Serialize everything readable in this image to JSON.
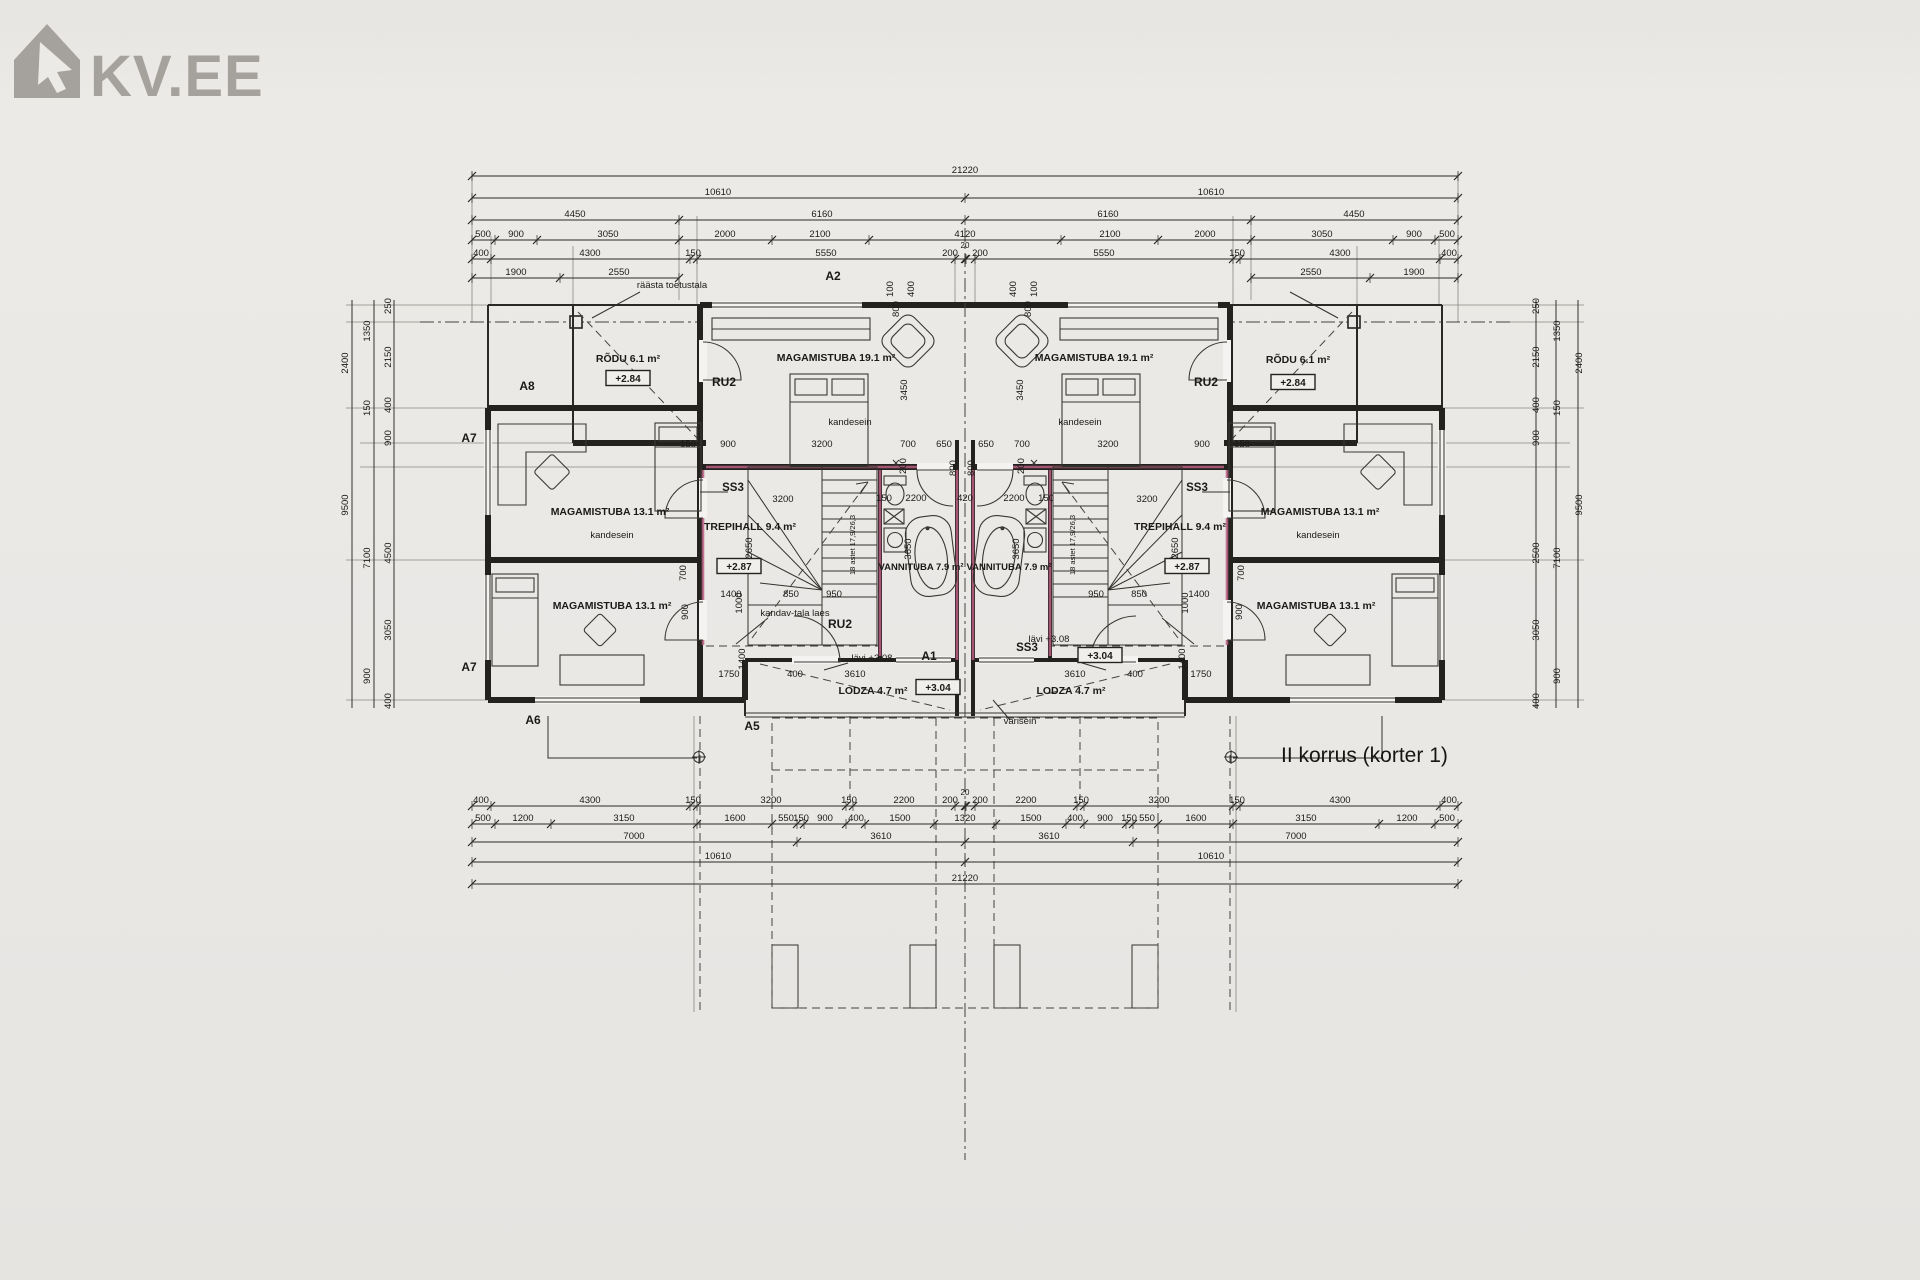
{
  "logo": {
    "text": "KV.EE",
    "icon": "house-cursor-icon",
    "color": "#a5a19c"
  },
  "caption": "II korrus (korter 1)",
  "colors": {
    "paper": "#eae8e5",
    "ink": "#1b1a18",
    "wall": "#24221e",
    "wall_accent": "#b85f84",
    "logo": "#a5a19c"
  },
  "dim_rows": [
    {
      "y": 176,
      "ticks": [
        472,
        1458
      ],
      "labels": [
        [
          "21220",
          965
        ]
      ]
    },
    {
      "y": 198,
      "ticks": [
        472,
        965,
        1458
      ],
      "labels": [
        [
          "10610",
          718
        ],
        [
          "10610",
          1211
        ]
      ]
    },
    {
      "y": 220,
      "ticks": [
        472,
        679,
        965,
        1251,
        1458
      ],
      "labels": [
        [
          "4450",
          575
        ],
        [
          "6160",
          822
        ],
        [
          "6160",
          1108
        ],
        [
          "4450",
          1354
        ]
      ]
    },
    {
      "y": 240,
      "ticks": [
        472,
        495,
        537,
        679,
        772,
        869,
        1061,
        1158,
        1251,
        1393,
        1435,
        1458
      ],
      "labels": [
        [
          "500",
          483
        ],
        [
          "900",
          516
        ],
        [
          "3050",
          608
        ],
        [
          "2000",
          725
        ],
        [
          "2100",
          820
        ],
        [
          "4120",
          965
        ],
        [
          "2100",
          1110
        ],
        [
          "2000",
          1205
        ],
        [
          "3050",
          1322
        ],
        [
          "900",
          1414
        ],
        [
          "500",
          1447
        ]
      ]
    },
    {
      "y": 259,
      "ticks": [
        472,
        491,
        690,
        697,
        955,
        965,
        966,
        975,
        1233,
        1240,
        1440,
        1458
      ],
      "labels": [
        [
          "400",
          481
        ],
        [
          "4300",
          590
        ],
        [
          "150",
          693
        ],
        [
          "5550",
          826
        ],
        [
          "200",
          950
        ],
        [
          "20",
          965,
          -8
        ],
        [
          "200",
          980
        ],
        [
          "5550",
          1104
        ],
        [
          "150",
          1237
        ],
        [
          "4300",
          1340
        ],
        [
          "400",
          1449
        ]
      ]
    },
    {
      "y": 278,
      "spans": [
        [
          472,
          679
        ],
        [
          1251,
          1458
        ]
      ],
      "ticks": [
        472,
        560,
        679,
        1251,
        1370,
        1458
      ],
      "labels": [
        [
          "1900",
          516
        ],
        [
          "2550",
          619
        ],
        [
          "2550",
          1311
        ],
        [
          "1900",
          1414
        ]
      ]
    },
    {
      "y": 806,
      "ticks": [
        472,
        491,
        690,
        697,
        846,
        853,
        955,
        965,
        966,
        975,
        1077,
        1084,
        1233,
        1240,
        1440,
        1458
      ],
      "labels": [
        [
          "400",
          481
        ],
        [
          "4300",
          590
        ],
        [
          "150",
          693
        ],
        [
          "3200",
          771
        ],
        [
          "150",
          849
        ],
        [
          "2200",
          904
        ],
        [
          "200",
          950
        ],
        [
          "20",
          965,
          -8
        ],
        [
          "200",
          980
        ],
        [
          "2200",
          1026
        ],
        [
          "150",
          1081
        ],
        [
          "3200",
          1159
        ],
        [
          "150",
          1237
        ],
        [
          "4300",
          1340
        ],
        [
          "400",
          1449
        ]
      ]
    },
    {
      "y": 824,
      "ticks": [
        472,
        495,
        551,
        697,
        772,
        797,
        804,
        846,
        865,
        934,
        996,
        1066,
        1084,
        1126,
        1133,
        1158,
        1233,
        1379,
        1435,
        1458
      ],
      "labels": [
        [
          "500",
          483
        ],
        [
          "1200",
          523
        ],
        [
          "3150",
          624
        ],
        [
          "1600",
          735
        ],
        [
          "550",
          786
        ],
        [
          "150",
          801
        ],
        [
          "900",
          825
        ],
        [
          "400",
          856
        ],
        [
          "1500",
          900
        ],
        [
          "1320",
          965
        ],
        [
          "1500",
          1031
        ],
        [
          "400",
          1075
        ],
        [
          "900",
          1105
        ],
        [
          "150",
          1129
        ],
        [
          "550",
          1147
        ],
        [
          "1600",
          1196
        ],
        [
          "3150",
          1306
        ],
        [
          "1200",
          1407
        ],
        [
          "500",
          1447
        ]
      ]
    },
    {
      "y": 842,
      "ticks": [
        472,
        797,
        965,
        1133,
        1458
      ],
      "labels": [
        [
          "7000",
          634
        ],
        [
          "3610",
          881
        ],
        [
          "3610",
          1049
        ],
        [
          "7000",
          1296
        ]
      ]
    },
    {
      "y": 862,
      "ticks": [
        472,
        965,
        1458
      ],
      "labels": [
        [
          "10610",
          718
        ],
        [
          "10610",
          1211
        ]
      ]
    },
    {
      "y": 884,
      "ticks": [
        472,
        1458
      ],
      "labels": [
        [
          "21220",
          965
        ]
      ]
    }
  ],
  "h_dims": [
    [
      "150",
      688,
      447
    ],
    [
      "900",
      728,
      447
    ],
    [
      "3200",
      822,
      447
    ],
    [
      "700",
      908,
      447
    ],
    [
      "650",
      944,
      447
    ],
    [
      "650",
      986,
      447
    ],
    [
      "700",
      1022,
      447
    ],
    [
      "3200",
      1108,
      447
    ],
    [
      "900",
      1202,
      447
    ],
    [
      "150",
      1242,
      447
    ],
    [
      "3200",
      783,
      502
    ],
    [
      "3200",
      1147,
      502
    ],
    [
      "150",
      884,
      501
    ],
    [
      "2200",
      916,
      501
    ],
    [
      "420",
      965,
      501
    ],
    [
      "2200",
      1014,
      501
    ],
    [
      "150",
      1046,
      501
    ],
    [
      "1400",
      731,
      597
    ],
    [
      "850",
      791,
      597
    ],
    [
      "950",
      834,
      597
    ],
    [
      "950",
      1096,
      597
    ],
    [
      "850",
      1139,
      597
    ],
    [
      "1400",
      1199,
      597
    ],
    [
      "1750",
      729,
      677
    ],
    [
      "400",
      795,
      677
    ],
    [
      "3610",
      855,
      677
    ],
    [
      "3610",
      1075,
      677
    ],
    [
      "400",
      1135,
      677
    ],
    [
      "1750",
      1201,
      677
    ]
  ],
  "v_dims": [
    [
      "3450",
      907,
      390
    ],
    [
      "3450",
      1023,
      390
    ],
    [
      "2650",
      752,
      548
    ],
    [
      "2650",
      1178,
      548
    ],
    [
      "3650",
      911,
      549
    ],
    [
      "3650",
      1019,
      549
    ],
    [
      "1000",
      742,
      603
    ],
    [
      "1000",
      1188,
      603
    ],
    [
      "1400",
      745,
      659
    ],
    [
      "1400",
      1185,
      659
    ],
    [
      "900",
      688,
      612
    ],
    [
      "900",
      1242,
      612
    ],
    [
      "700",
      686,
      573
    ],
    [
      "700",
      1244,
      573
    ],
    [
      "200",
      906,
      466
    ],
    [
      "200",
      1024,
      466
    ],
    [
      "800",
      956,
      468
    ],
    [
      "800",
      974,
      468
    ],
    [
      "100",
      893,
      289
    ],
    [
      "100",
      1037,
      289
    ],
    [
      "400",
      914,
      289
    ],
    [
      "400",
      1016,
      289
    ],
    [
      "800",
      899,
      309
    ],
    [
      "800",
      1031,
      309
    ],
    [
      "250",
      391,
      306
    ],
    [
      "1350",
      370,
      331
    ],
    [
      "2150",
      391,
      357
    ],
    [
      "2400",
      348,
      363
    ],
    [
      "400",
      391,
      405
    ],
    [
      "150",
      370,
      408
    ],
    [
      "900",
      391,
      438
    ],
    [
      "9500",
      348,
      505
    ],
    [
      "4500",
      391,
      553
    ],
    [
      "7100",
      370,
      558
    ],
    [
      "3050",
      391,
      630
    ],
    [
      "900",
      370,
      676
    ],
    [
      "400",
      391,
      701
    ],
    [
      "250",
      1539,
      306
    ],
    [
      "1350",
      1560,
      331
    ],
    [
      "2150",
      1539,
      357
    ],
    [
      "2400",
      1582,
      363
    ],
    [
      "400",
      1539,
      405
    ],
    [
      "150",
      1560,
      408
    ],
    [
      "900",
      1539,
      438
    ],
    [
      "9500",
      1582,
      505
    ],
    [
      "2500",
      1539,
      553
    ],
    [
      "7100",
      1560,
      558
    ],
    [
      "3050",
      1539,
      630
    ],
    [
      "900",
      1560,
      676
    ],
    [
      "400",
      1539,
      701
    ],
    [
      "18 astet 17,9/26,3",
      855,
      545,
      7.5
    ],
    [
      "18 astet 17,9/26,3",
      1075,
      545,
      7.5
    ]
  ],
  "plan_labels": [
    {
      "n": "axis-label-a2",
      "t": "A2",
      "x": 833,
      "y": 280,
      "s": 12,
      "b": 1
    },
    {
      "n": "note-raasta-toetustala",
      "t": "räästa toetustala",
      "x": 672,
      "y": 288,
      "s": 9.5
    },
    {
      "n": "room-rodu-left",
      "t": "RÕDU 6.1 m²",
      "x": 628,
      "y": 362,
      "s": 10.5,
      "b": 1
    },
    {
      "n": "axis-label-a8",
      "t": "A8",
      "x": 527,
      "y": 390,
      "s": 12,
      "b": 1
    },
    {
      "n": "door-code-ru2-left-top",
      "t": "RU2",
      "x": 724,
      "y": 386,
      "s": 12,
      "b": 1
    },
    {
      "n": "room-magamistuba-19-left",
      "t": "MAGAMISTUBA 19.1 m²",
      "x": 836,
      "y": 361,
      "s": 10.5,
      "b": 1
    },
    {
      "n": "note-kandesein-left-top",
      "t": "kandesein",
      "x": 850,
      "y": 425,
      "s": 9.5
    },
    {
      "n": "axis-label-a7-upper",
      "t": "A7",
      "x": 469,
      "y": 442,
      "s": 12,
      "b": 1
    },
    {
      "n": "room-magamistuba-13-left-upper",
      "t": "MAGAMISTUBA 13.1 m²",
      "x": 610,
      "y": 515,
      "s": 10.5,
      "b": 1
    },
    {
      "n": "note-kandesein-left-mid",
      "t": "kandesein",
      "x": 612,
      "y": 538,
      "s": 9.5
    },
    {
      "n": "window-code-ss3-left",
      "t": "SS3",
      "x": 733,
      "y": 491,
      "s": 11.5,
      "b": 1
    },
    {
      "n": "room-trepihall-left",
      "t": "TREPIHALL 9.4 m²",
      "x": 750,
      "y": 530,
      "s": 10.5,
      "b": 1
    },
    {
      "n": "room-vannituba-left",
      "t": "VANNITUBA 7.9 m²",
      "x": 921,
      "y": 570,
      "s": 9.5,
      "b": 1
    },
    {
      "n": "room-magamistuba-13-left-lower",
      "t": "MAGAMISTUBA 13.1 m²",
      "x": 612,
      "y": 609,
      "s": 10.5,
      "b": 1
    },
    {
      "n": "axis-label-a7-lower",
      "t": "A7",
      "x": 469,
      "y": 671,
      "s": 12,
      "b": 1
    },
    {
      "n": "note-kandav-tala",
      "t": "kandav-tala laes",
      "x": 795,
      "y": 616,
      "s": 9.5
    },
    {
      "n": "door-code-ru2-left-bottom",
      "t": "RU2",
      "x": 840,
      "y": 628,
      "s": 12,
      "b": 1
    },
    {
      "n": "note-lavi-left",
      "t": "lävi +3.08",
      "x": 872,
      "y": 661,
      "s": 9.5
    },
    {
      "n": "axis-label-a1",
      "t": "A1",
      "x": 929,
      "y": 660,
      "s": 12,
      "b": 1
    },
    {
      "n": "room-lodza-left",
      "t": "LODZA 4.7 m²",
      "x": 873,
      "y": 694,
      "s": 10.5,
      "b": 1
    },
    {
      "n": "axis-label-a6",
      "t": "A6",
      "x": 533,
      "y": 724,
      "s": 12,
      "b": 1
    },
    {
      "n": "axis-label-a5",
      "t": "A5",
      "x": 752,
      "y": 730,
      "s": 12,
      "b": 1
    },
    {
      "n": "note-varisein",
      "t": "varisein",
      "x": 1020,
      "y": 724,
      "s": 9.5
    },
    {
      "n": "room-magamistuba-19-right",
      "t": "MAGAMISTUBA 19.1 m²",
      "x": 1094,
      "y": 361,
      "s": 10.5,
      "b": 1
    },
    {
      "n": "note-kandesein-right-top",
      "t": "kandesein",
      "x": 1080,
      "y": 425,
      "s": 9.5
    },
    {
      "n": "room-rodu-right",
      "t": "RÕDU 6.1 m²",
      "x": 1298,
      "y": 363,
      "s": 10.5,
      "b": 1
    },
    {
      "n": "door-code-ru2-right-top",
      "t": "RU2",
      "x": 1206,
      "y": 386,
      "s": 12,
      "b": 1
    },
    {
      "n": "window-code-ss3-right",
      "t": "SS3",
      "x": 1197,
      "y": 491,
      "s": 11.5,
      "b": 1
    },
    {
      "n": "room-trepihall-right",
      "t": "TREPIHALL 9.4 m²",
      "x": 1180,
      "y": 530,
      "s": 10.5,
      "b": 1
    },
    {
      "n": "room-vannituba-right",
      "t": "VANNITUBA 7.9 m²",
      "x": 1009,
      "y": 570,
      "s": 9.5,
      "b": 1
    },
    {
      "n": "room-magamistuba-13-right-upper",
      "t": "MAGAMISTUBA 13.1 m²",
      "x": 1320,
      "y": 515,
      "s": 10.5,
      "b": 1
    },
    {
      "n": "note-kandesein-right-mid",
      "t": "kandesein",
      "x": 1318,
      "y": 538,
      "s": 9.5
    },
    {
      "n": "room-magamistuba-13-right-lower",
      "t": "MAGAMISTUBA 13.1 m²",
      "x": 1316,
      "y": 609,
      "s": 10.5,
      "b": 1
    },
    {
      "n": "window-code-ss3-right-bottom",
      "t": "SS3",
      "x": 1027,
      "y": 651,
      "s": 11.5,
      "b": 1
    },
    {
      "n": "note-lavi-right",
      "t": "lävi +3.08",
      "x": 1049,
      "y": 642,
      "s": 9.5
    },
    {
      "n": "room-lodza-right",
      "t": "LODZA 4.7 m²",
      "x": 1071,
      "y": 694,
      "s": 10.5,
      "b": 1
    }
  ],
  "boxed_labels": [
    {
      "n": "elevation-rodu-left",
      "t": "+2.84",
      "x": 628,
      "y": 382
    },
    {
      "n": "elevation-rodu-right",
      "t": "+2.84",
      "x": 1293,
      "y": 386
    },
    {
      "n": "elevation-trepihall-left",
      "t": "+2.87",
      "x": 739,
      "y": 570
    },
    {
      "n": "elevation-trepihall-right",
      "t": "+2.87",
      "x": 1187,
      "y": 570
    },
    {
      "n": "elevation-lodza-left",
      "t": "+3.04",
      "x": 938,
      "y": 691
    },
    {
      "n": "elevation-lodza-right",
      "t": "+3.04",
      "x": 1100,
      "y": 659
    }
  ]
}
